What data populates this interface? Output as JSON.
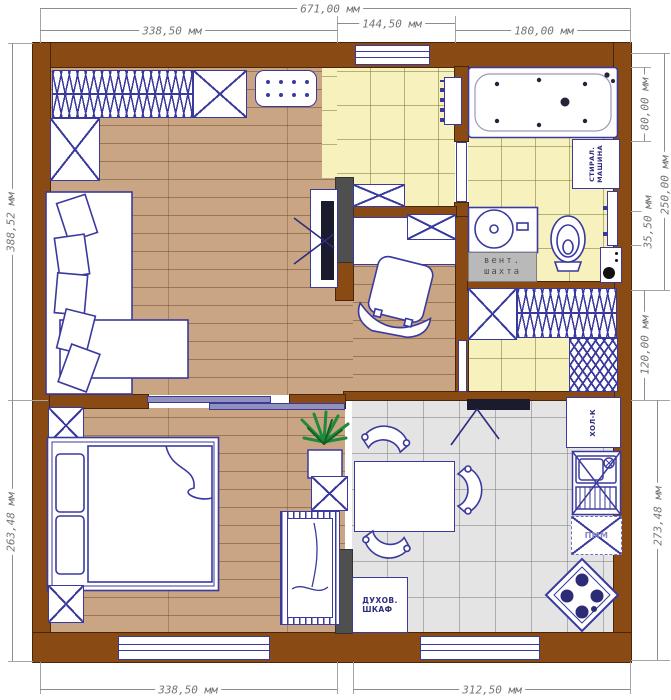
{
  "meta": {
    "type": "apartment floor plan drawing",
    "units": "мм"
  },
  "dimensions": {
    "top_overall": "671,00 мм",
    "top_left": "338,50 мм",
    "top_middle": "144,50 мм",
    "top_right": "180,00 мм",
    "left_upper": "388,52 мм",
    "left_lower": "263,48 мм",
    "right_bath_width": "80,00 мм",
    "right_bathroom_total": "250,00 мм",
    "right_towel_zone": "35,50 мм",
    "right_closet": "120,00 мм",
    "right_kitchen": "273,48 мм",
    "bottom_left": "338,50 мм",
    "bottom_right": "312,50 мм"
  },
  "labels": {
    "vent_shaft": [
      "вент.",
      "шахта"
    ],
    "washing_machine": [
      "СТИРАЛ.",
      "МАШИНА"
    ],
    "fridge": "ХОЛ-К",
    "dishwasher": "ПММ",
    "oven": [
      "ДУХОВ.",
      "ШКАФ"
    ]
  },
  "colors": {
    "wall": "#8a4a14",
    "partition": "#4f4f4f",
    "furniture_outline": "#3a3a9e",
    "wood_floor": "#c9a584",
    "tile_yellow": "#f6f1bd",
    "tile_gray": "#e4e4e4",
    "dimension_text": "#757575",
    "vent_shaft_fill": "#b9b9b9",
    "tv_screen": "#1b1b2e",
    "plant_green": "#1e8a3a",
    "sliding_door": "#9191bb"
  }
}
